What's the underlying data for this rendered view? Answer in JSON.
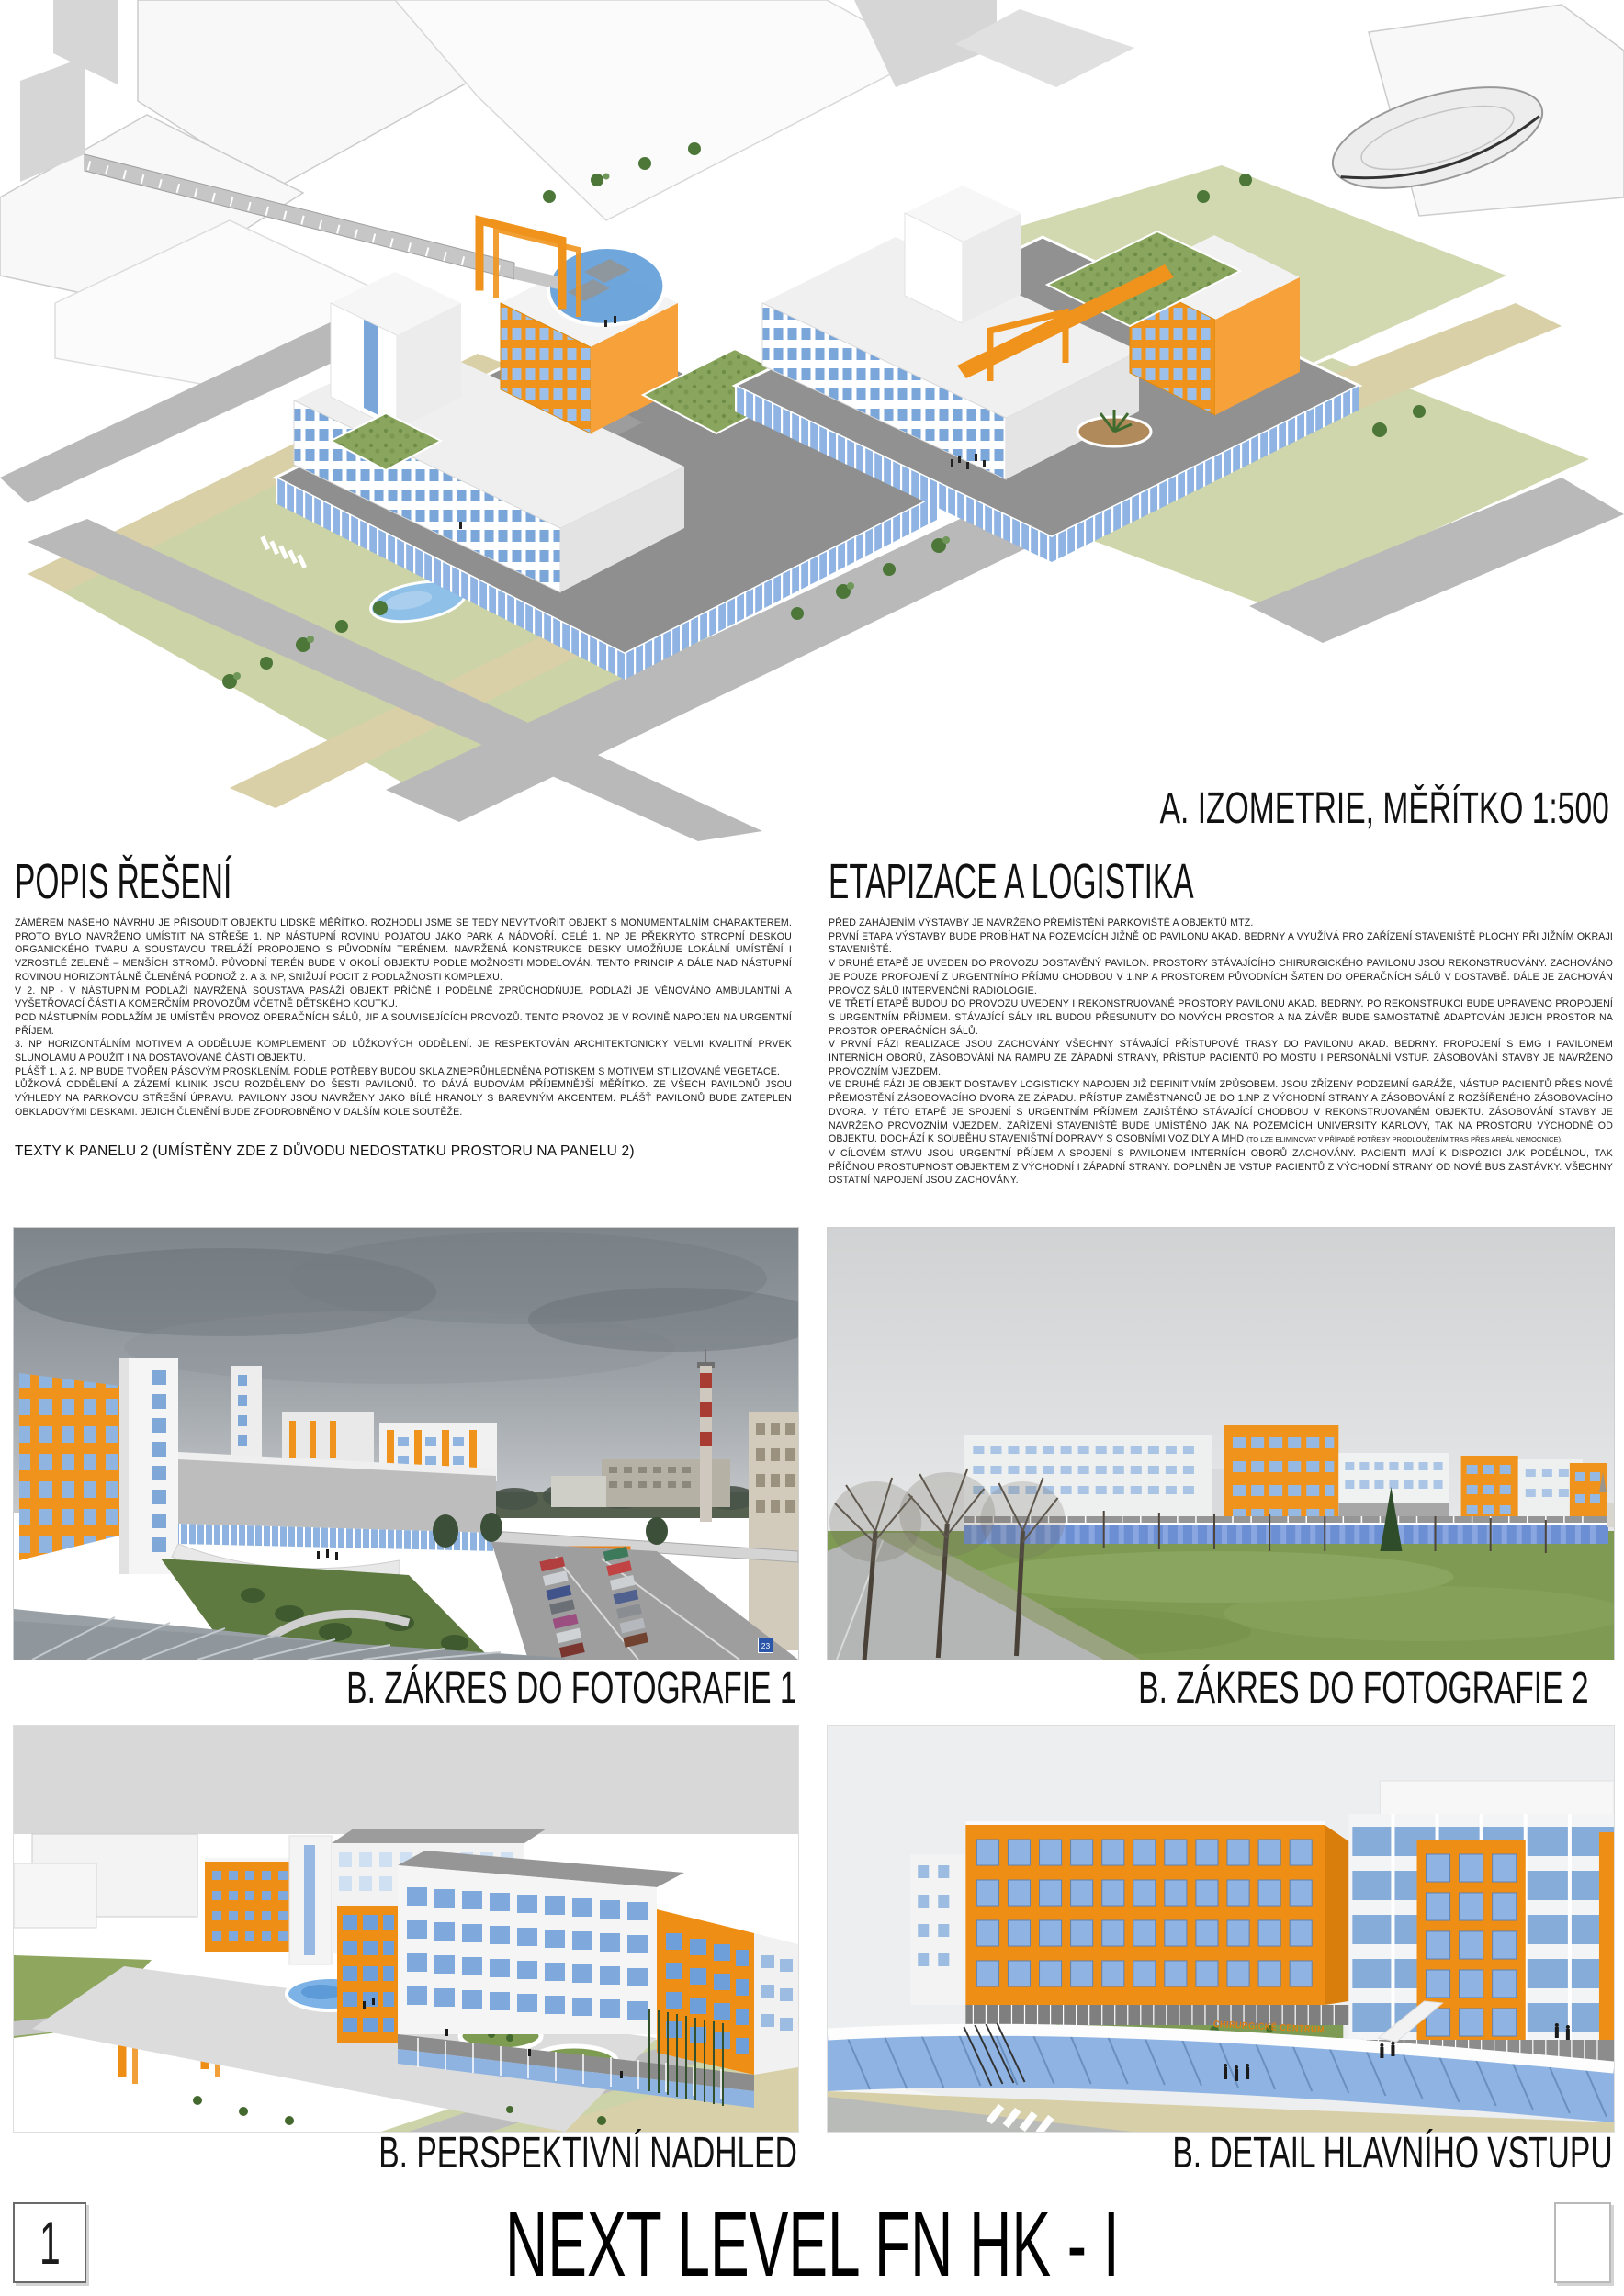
{
  "page": {
    "panel_number": "1",
    "project_title": "NEXT LEVEL FN HK - I"
  },
  "isometric": {
    "caption": "A. IZOMETRIE, MĚŘÍTKO 1:500"
  },
  "popis": {
    "heading": "POPIS ŘEŠENÍ",
    "paragraphs": [
      "ZÁMĚREM NAŠEHO NÁVRHU JE PŘISOUDIT OBJEKTU LIDSKÉ MĚŘÍTKO. ROZHODLI JSME SE TEDY NEVYTVOŘIT OBJEKT S MONUMENTÁLNÍM CHARAKTEREM. PROTO BYLO NAVRŽENO UMÍSTIT NA STŘEŠE 1. NP NÁSTUPNÍ ROVINU POJATOU JAKO PARK A NÁDVOŘÍ. CELÉ 1. NP JE PŘEKRYTO STROPNÍ DESKOU ORGANICKÉHO TVARU A SOUSTAVOU TRELÁŽÍ PROPOJENO S PŮVODNÍM TERÉNEM. NAVRŽENÁ KONSTRUKCE DESKY UMOŽŇUJE LOKÁLNÍ UMÍSTĚNÍ I VZROSTLÉ ZELENĚ – MENŠÍCH STROMŮ. PŮVODNÍ TERÉN BUDE V OKOLÍ OBJEKTU PODLE MOŽNOSTI MODELOVÁN. TENTO PRINCIP A DÁLE NAD NÁSTUPNÍ ROVINOU HORIZONTÁLNĚ ČLENĚNÁ PODNOŽ 2. A 3. NP, SNIŽUJÍ POCIT Z PODLAŽNOSTI KOMPLEXU.",
      "V 2. NP - V NÁSTUPNÍM PODLAŽÍ NAVRŽENÁ SOUSTAVA PASÁŽÍ OBJEKT PŘÍČNĚ I PODÉLNĚ ZPRŮCHODŇUJE. PODLAŽÍ JE VĚNOVÁNO AMBULANTNÍ A VYŠETŘOVACÍ ČÁSTI A KOMERČNÍM PROVOZŮM VČETNĚ DĚTSKÉHO KOUTKU.",
      "POD NÁSTUPNÍM PODLAŽÍM JE UMÍSTĚN PROVOZ OPERAČNÍCH SÁLŮ, JIP A SOUVISEJÍCÍCH PROVOZŮ. TENTO PROVOZ JE V ROVINĚ NAPOJEN NA URGENTNÍ PŘÍJEM.",
      "3. NP HORIZONTÁLNÍM MOTIVEM A ODDĚLUJE KOMPLEMENT OD LŮŽKOVÝCH ODDĚLENÍ. JE RESPEKTOVÁN ARCHITEKTONICKY VELMI KVALITNÍ PRVEK SLUNOLAMU A POUŽIT I NA DOSTAVOVANÉ ČÁSTI OBJEKTU.",
      "PLÁŠŤ 1. A 2. NP BUDE TVOŘEN PÁSOVÝM PROSKLENÍM. PODLE POTŘEBY BUDOU SKLA ZNEPRŮHLEDNĚNA POTISKEM S MOTIVEM STILIZOVANÉ VEGETACE.",
      "LŮŽKOVÁ ODDĚLENÍ A ZÁZEMÍ KLINIK JSOU ROZDĚLENY DO ŠESTI PAVILONŮ. TO DÁVÁ BUDOVÁM PŘÍJEMNĚJŠÍ MĚŘÍTKO. ZE VŠECH PAVILONŮ JSOU VÝHLEDY NA PARKOVOU STŘEŠNÍ ÚPRAVU. PAVILONY JSOU NAVRŽENY JAKO BÍLÉ HRANOLY S BAREVNÝM AKCENTEM. PLÁŠŤ PAVILONŮ BUDE ZATEPLEN OBKLADOVÝMI DESKAMI. JEJICH ČLENĚNÍ BUDE ZPODROBNĚNO V DALŠÍM KOLE SOUTĚŽE."
    ],
    "note": "TEXTY K PANELU 2 (UMÍSTĚNY ZDE Z DŮVODU NEDOSTATKU PROSTORU NA PANELU 2)"
  },
  "etapizace": {
    "heading": "ETAPIZACE A LOGISTIKA",
    "paragraphs": [
      "PŘED ZAHÁJENÍM VÝSTAVBY JE NAVRŽENO PŘEMÍSTĚNÍ PARKOVIŠTĚ A OBJEKTŮ MTZ.",
      "PRVNÍ ETAPA VÝSTAVBY BUDE PROBÍHAT NA POZEMCÍCH JIŽNĚ OD PAVILONU AKAD. BEDRNY A VYUŽÍVÁ PRO ZAŘÍZENÍ STAVENIŠTĚ PLOCHY PŘI JIŽNÍM OKRAJI STAVENIŠTĚ.",
      "V DRUHÉ ETAPĚ JE UVEDEN DO PROVOZU DOSTAVĚNÝ PAVILON. PROSTORY STÁVAJÍCÍHO CHIRURGICKÉHO PAVILONU JSOU REKONSTRUOVÁNY. ZACHOVÁNO JE POUZE PROPOJENÍ Z URGENTNÍHO PŘÍJMU CHODBOU V 1.NP A PROSTOREM PŮVODNÍCH ŠATEN DO OPERAČNÍCH SÁLŮ V DOSTAVBĚ. DÁLE JE ZACHOVÁN PROVOZ SÁLŮ INTERVENČNÍ RADIOLOGIE.",
      "VE TŘETÍ ETAPĚ BUDOU DO PROVOZU UVEDENY I REKONSTRUOVANÉ PROSTORY PAVILONU AKAD. BEDRNY. PO REKONSTRUKCI BUDE UPRAVENO PROPOJENÍ S URGENTNÍM PŘÍJMEM. STÁVAJÍCÍ SÁLY IRL BUDOU PŘESUNUTY DO NOVÝCH PROSTOR A NA ZÁVĚR BUDE SAMOSTATNĚ ADAPTOVÁN JEJICH PROSTOR NA PROSTOR OPERAČNÍCH SÁLŮ.",
      "V PRVNÍ FÁZI REALIZACE JSOU ZACHOVÁNY VŠECHNY STÁVAJÍCÍ PŘÍSTUPOVÉ TRASY DO PAVILONU AKAD. BEDRNY. PROPOJENÍ S EMG I PAVILONEM INTERNÍCH OBORŮ, ZÁSOBOVÁNÍ NA RAMPU ZE ZÁPADNÍ STRANY, PŘÍSTUP PACIENTŮ PO MOSTU I PERSONÁLNÍ VSTUP. ZÁSOBOVÁNÍ STAVBY JE NAVRŽENO PROVOZNÍM VJEZDEM."
    ],
    "paragraph6_main": "VE DRUHÉ FÁZI JE OBJEKT DOSTAVBY LOGISTICKY NAPOJEN JIŽ DEFINITIVNÍM ZPŮSOBEM. JSOU ZŘÍZENY PODZEMNÍ GARÁŽE, NÁSTUP PACIENTŮ PŘES NOVÉ PŘEMOSTĚNÍ ZÁSOBOVACÍHO DVORA ZE ZÁPADU. PŘÍSTUP ZAMĚSTNANCŮ JE DO 1.NP Z VÝCHODNÍ STRANY A ZÁSOBOVÁNÍ Z ROZŠÍŘENÉHO ZÁSOBOVACÍHO DVORA. V TÉTO ETAPĚ JE SPOJENÍ S URGENTNÍM PŘÍJMEM ZAJIŠTĚNO STÁVAJÍCÍ CHODBOU V REKONSTRUOVANÉM OBJEKTU. ZÁSOBOVÁNÍ STAVBY JE NAVRŽENO PROVOZNÍM VJEZDEM. ZAŘÍZENÍ STAVENIŠTĚ BUDE UMÍSTĚNO JAK NA POZEMCÍCH UNIVERSITY KARLOVY, TAK NA PROSTORU VÝCHODNĚ OD OBJEKTU. DOCHÁZÍ K SOUBĚHU STAVENIŠTNÍ DOPRAVY S OSOBNÍMI VOZIDLY A MHD ",
    "paragraph6_footnote": "(TO LZE ELIMINOVAT V PŘÍPADĚ POTŘEBY PRODLOUŽENÍM TRAS PŘES AREÁL NEMOCNICE).",
    "paragraph7": "V CÍLOVÉM STAVU JSOU URGENTNÍ PŘÍJEM A SPOJENÍ S PAVILONEM INTERNÍCH OBORŮ ZACHOVÁNY. PACIENTI MAJÍ K DISPOZICI JAK PODÉLNOU, TAK PŘÍČNOU PROSTUPNOST OBJEKTEM Z VÝCHODNÍ I ZÁPADNÍ STRANY. DOPLNĚN JE VSTUP PACIENTŮ Z VÝCHODNÍ STRANY OD NOVÉ BUS ZASTÁVKY. VŠECHNY OSTATNÍ NAPOJENÍ JSOU ZACHOVÁNY."
  },
  "figures": {
    "photo1": {
      "caption": "B. ZÁKRES DO FOTOGRAFIE 1",
      "parking_sign": "23"
    },
    "photo2": {
      "caption": "B. ZÁKRES DO FOTOGRAFIE 2"
    },
    "render_overview": {
      "caption": "B. PERSPEKTIVNÍ NADHLED"
    },
    "render_entrance": {
      "caption": "B. DETAIL HLAVNÍHO VSTUPU",
      "building_sign": "CHIRURGICKÉ CENTRUM"
    }
  },
  "colors": {
    "accent_orange": "#F0931D",
    "window_blue": "#7AA6DA",
    "glass_blue": "#8FB3E2",
    "roof_gray": "#8E8E8E",
    "lawn_olive": "#CCD3A6",
    "grass_green": "#7F9B53",
    "sky_gray": "#9AA0A5"
  }
}
